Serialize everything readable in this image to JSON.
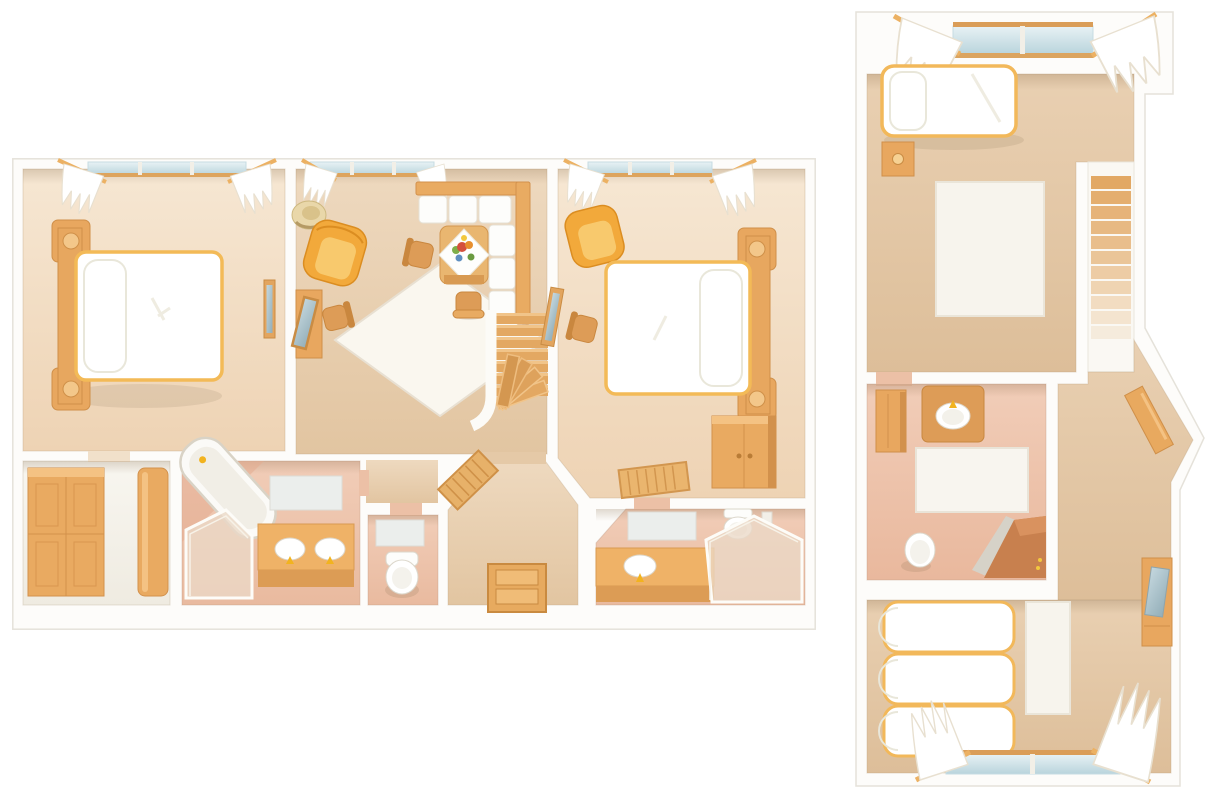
{
  "illustration": {
    "type": "floor-plan-set",
    "background": "#ffffff",
    "palette": {
      "wall": "#fdfcfa",
      "wall_outline": "#e5e2da",
      "floor_tan": "#e7cdad",
      "floor_peach": "#f3decb",
      "floor_pink": "#eec4ac",
      "floor_pale": "#f6f3ec",
      "wood": "#e8a75f",
      "wood_dark": "#cf8f49",
      "wood_light": "#f4c283",
      "armchair_yellow": "#f2a93b",
      "linen_white": "#ffffff",
      "linen_trim": "#f3ba57",
      "window_glass": "#cfe2ea",
      "mirror_glass": "#adc6cf",
      "shower_glass": "#ead9c6",
      "shower_terracotta": "#c8804e",
      "flower_red": "#d4503c",
      "flower_orange": "#e78f2e",
      "flower_green": "#7fae49",
      "flower_blue": "#5f8fc0",
      "flower_yellow": "#f2c83e"
    },
    "plans": [
      {
        "name": "main-floor-plan",
        "position": "left",
        "rooms": [
          {
            "name": "bedroom-left",
            "furniture": [
              "window-with-curtains",
              "double-bed",
              "wall-mirror"
            ]
          },
          {
            "name": "living-room",
            "furniture": [
              "window-with-curtains",
              "straw-hat",
              "armchair",
              "dressing-table-with-mirror",
              "stool",
              "side-chair",
              "corner-sofa",
              "coffee-table-with-flowers",
              "bench",
              "area-rug",
              "desk-chair",
              "staircase"
            ]
          },
          {
            "name": "bedroom-right",
            "furniture": [
              "window-with-curtains",
              "armchair",
              "double-bed",
              "leaning-mirror",
              "side-chair",
              "wardrobe",
              "floor-mat"
            ]
          },
          {
            "name": "walk-in-closet",
            "furniture": [
              "wardrobe-left",
              "wardrobe-right"
            ]
          },
          {
            "name": "family-bathroom",
            "furniture": [
              "bathtub",
              "shower-cabin",
              "double-sink-vanity",
              "wall-mirror"
            ]
          },
          {
            "name": "toilet-room",
            "furniture": [
              "wall-mirror",
              "toilet"
            ]
          },
          {
            "name": "entry-hall",
            "furniture": [
              "front-door",
              "doormat"
            ]
          },
          {
            "name": "ensuite-bathroom",
            "furniture": [
              "wall-mirror",
              "toilet",
              "wall-niche",
              "sink-vanity",
              "shower-cabin"
            ]
          }
        ]
      },
      {
        "name": "upper-floor-plan",
        "position": "right",
        "rooms": [
          {
            "name": "bedroom-top",
            "furniture": [
              "window-with-curtains",
              "single-bed",
              "nightstand",
              "area-rug",
              "staircase"
            ]
          },
          {
            "name": "bathroom",
            "furniture": [
              "storage-cabinet",
              "sink-vanity",
              "bath-mat",
              "toilet",
              "corner-shower"
            ]
          },
          {
            "name": "landing",
            "furniture": [
              "wall-shelf"
            ]
          },
          {
            "name": "bedroom-bottom",
            "furniture": [
              "single-bed-1",
              "single-bed-2",
              "single-bed-3",
              "runner-rug",
              "desk-with-mirror",
              "window-with-curtains"
            ]
          }
        ]
      }
    ]
  }
}
